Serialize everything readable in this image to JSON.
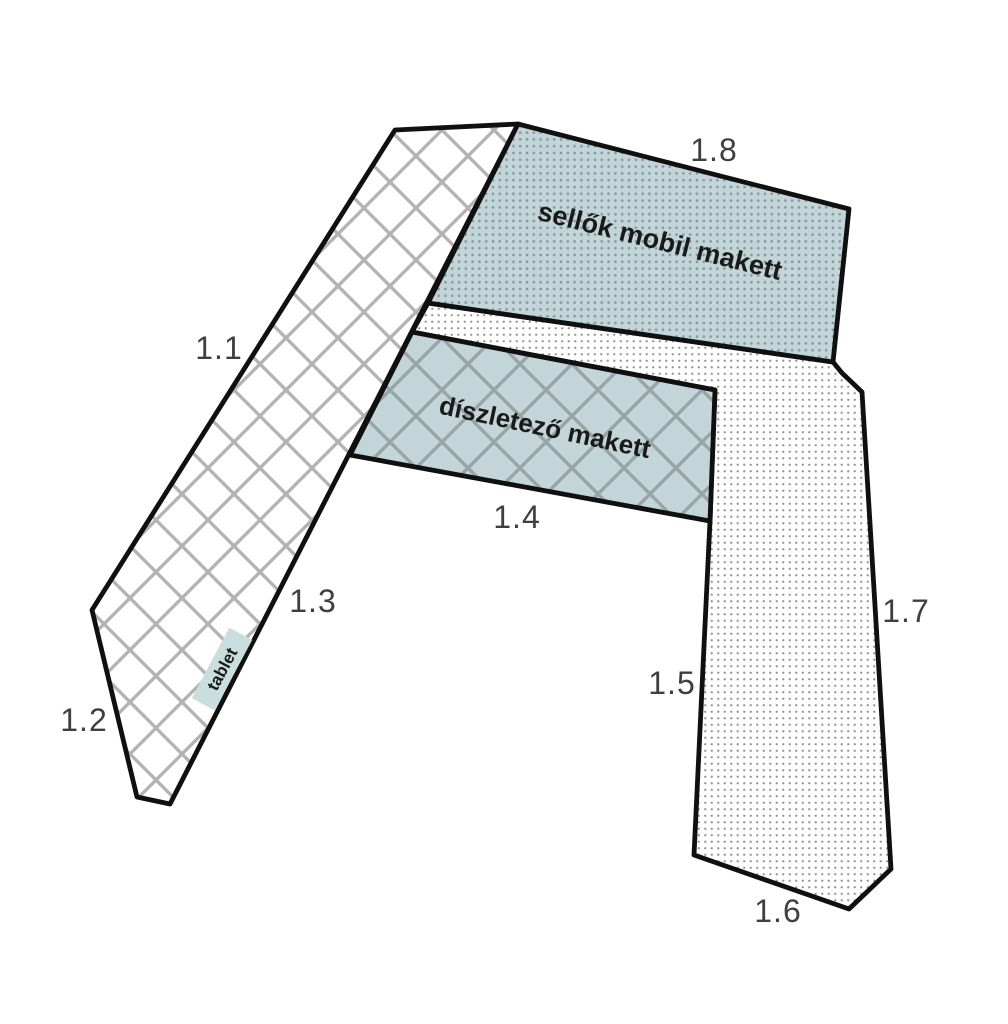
{
  "areas": [
    {
      "label": "1.1"
    },
    {
      "label": "1.2"
    },
    {
      "label": "1.3"
    },
    {
      "label": "1.4"
    },
    {
      "label": "1.5"
    },
    {
      "label": "1.6"
    },
    {
      "label": "1.7"
    },
    {
      "label": "1.8"
    }
  ],
  "regions": {
    "sellok": {
      "label": "sellők mobil makett"
    },
    "diszletezo": {
      "label": "díszletező makett"
    },
    "tablet": {
      "label": "tablet"
    }
  },
  "colors": {
    "white": "#ffffff",
    "outline": "#101010",
    "number_text": "#3f3f3f",
    "region_text": "#1a1a1a",
    "teal_fill": "#c3d5d8",
    "teal_dot": "#7f999d",
    "hatch_line": "#b3b3b3",
    "hatch_line_on_teal": "#98a5a8",
    "dot_on_white": "#949494",
    "tablet_highlight": "#cadedf"
  }
}
